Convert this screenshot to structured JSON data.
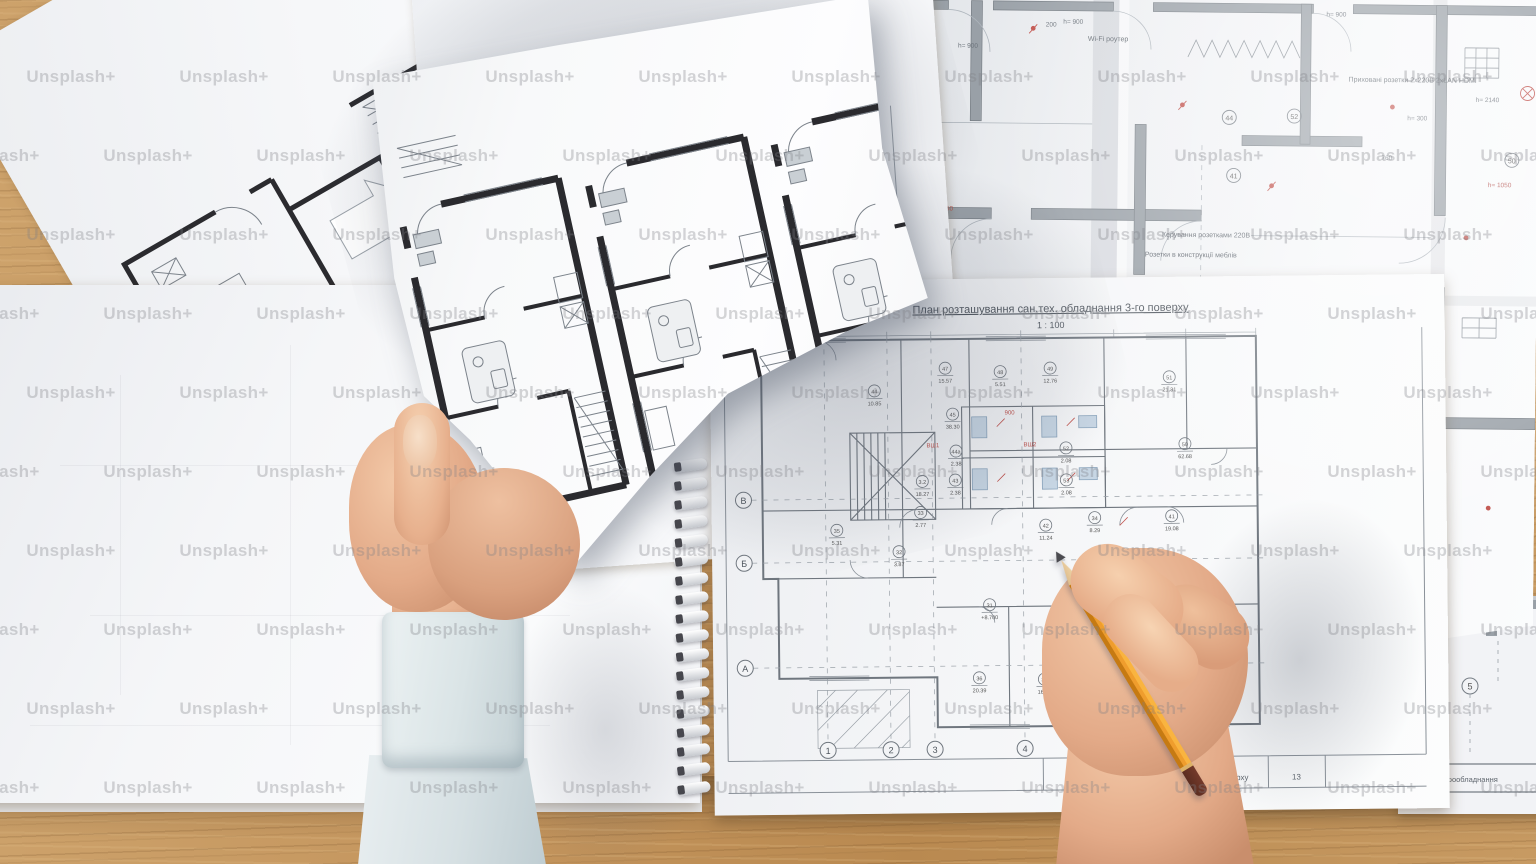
{
  "watermark": {
    "text": "Unsplash+",
    "color": "#7e7f85"
  },
  "palette": {
    "wood": "#c3945c",
    "wood_dark": "#9c743f",
    "paper": "#f4f5f7",
    "paper_bright": "#fbfcfd",
    "ink_wall": "#2a2a2e",
    "wall_gray": "#99a0a7",
    "line_gray": "#767d85",
    "red_annotation": "#c0504a",
    "fixture_blue": "#9db4c9",
    "skin": "#e3aa88",
    "sleeve_blue": "#dbe4e7",
    "pencil_orange": "#ef9d2d"
  },
  "notebook_plan": {
    "title": "План розташування сан.тех. обладнання 3-го поверху",
    "scale": "1 : 100",
    "row_labels": [
      "В",
      "Б",
      "А"
    ],
    "column_labels": [
      "1",
      "2",
      "3",
      "4"
    ],
    "room_tags": [
      {
        "id": "44",
        "area": "10.85"
      },
      {
        "id": "47",
        "area": "15.57"
      },
      {
        "id": "48",
        "area": "5.51"
      },
      {
        "id": "49",
        "area": "12.76"
      },
      {
        "id": "51",
        "area": "21.31"
      },
      {
        "id": "45",
        "area": "38.30"
      },
      {
        "id": "44а",
        "area": "2.38"
      },
      {
        "id": "43",
        "area": "2.38"
      },
      {
        "id": "52",
        "area": "2.08"
      },
      {
        "id": "53",
        "area": "2.08"
      },
      {
        "id": "50",
        "area": "62.68"
      },
      {
        "id": "3.2",
        "area": "18.27"
      },
      {
        "id": "33",
        "area": "2.77"
      },
      {
        "id": "35",
        "area": "5.31"
      },
      {
        "id": "32",
        "area": "3.87"
      },
      {
        "id": "34",
        "area": "8.29"
      },
      {
        "id": "41",
        "area": "19.08"
      },
      {
        "id": "42",
        "area": "11.24"
      },
      {
        "id": "31",
        "area": "+8.700"
      },
      {
        "id": "36",
        "area": "20.39"
      },
      {
        "id": "37",
        "area": "16.57"
      }
    ],
    "red_marks": [
      "900",
      "ВШ1",
      "ВШ2",
      "150",
      "150"
    ],
    "titleblock": {
      "left_text": "го поверху",
      "page": "13"
    }
  },
  "electrical_plan": {
    "labels": [
      "Wi-Fi роутер",
      "Приховані розетки 2х220В 2хLAN HDMI",
      "Керування розетками 220В",
      "Розетки в конструкції меблів"
    ],
    "dims": [
      "h= 900",
      "h= 300",
      "760",
      "h= 1050",
      "h= 2140",
      "h= 900",
      "h= 300",
      "h= 900",
      "h= 2750",
      "200",
      "h= 300",
      "h= 1050"
    ],
    "tags": [
      "44",
      "41",
      "52",
      "50"
    ]
  },
  "corner_sheet": {
    "bottom_text": "вання електрообладнання",
    "bubble": "5"
  }
}
